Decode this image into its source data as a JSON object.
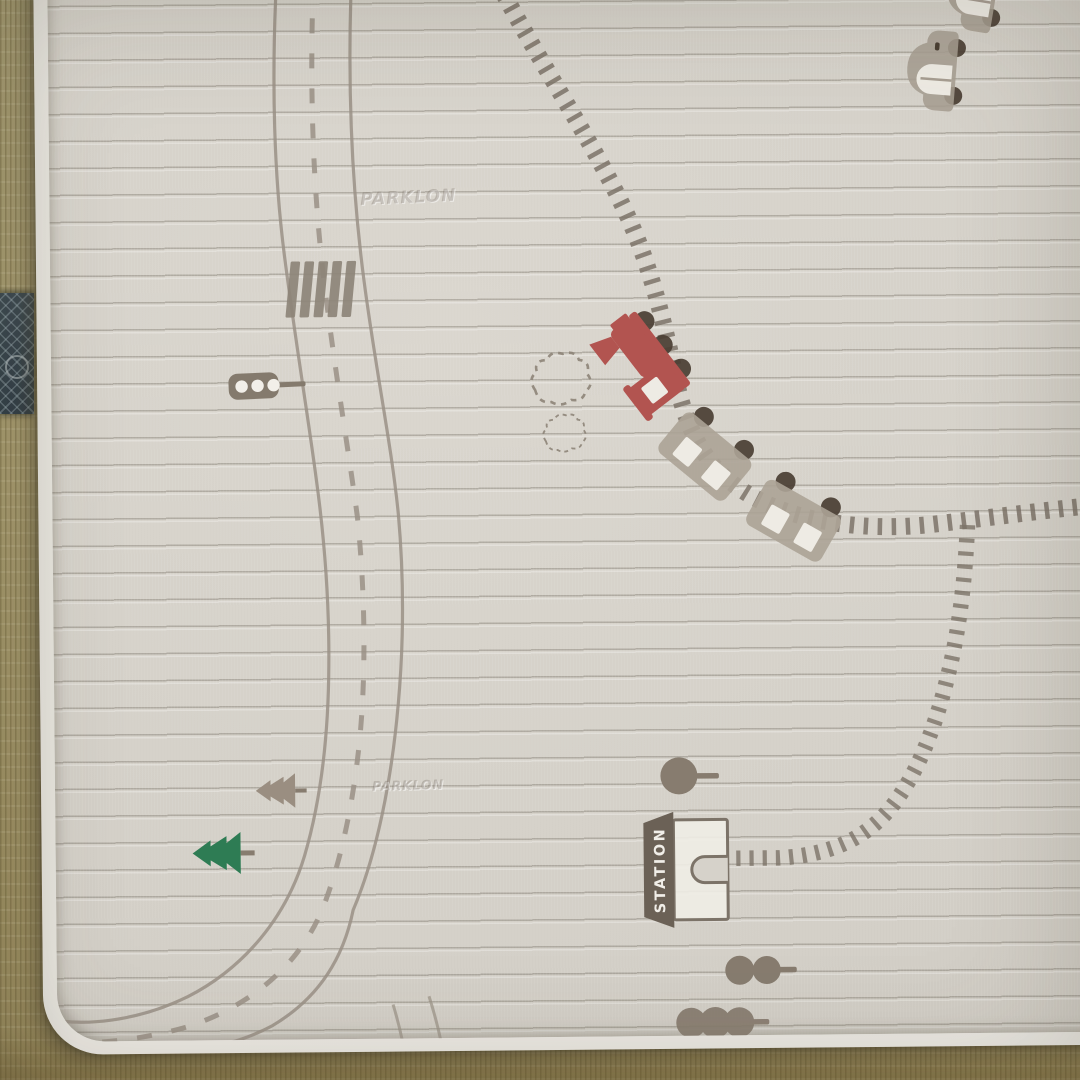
{
  "scene": {
    "type": "photograph",
    "description": "Foldable baby play mat printed with a toy road and railway map, lying on a tatami floor",
    "background": "tatami flooring with a dark diamond-patterned border band on the left"
  },
  "mat": {
    "station_sign": "STATION",
    "brand_watermark": "PARKLON",
    "icons": {
      "steam-train-icon": "red cartoon steam locomotive riding the railway",
      "train-wagon-icon": "gray train wagon with two white windows",
      "car-icon": "gray cartoon car with arched white window",
      "traffic-light-icon": "horizontal traffic light with three white lamps on a pole",
      "crosswalk-icon": "zebra crosswalk stripes across the road",
      "pine-tree-green-icon": "green pine tree lying along the mat",
      "pine-tree-taupe-icon": "taupe pine tree lying along the mat",
      "lollipop-tree-icon": "round tree with short trunk",
      "ball-tree-icon": "bush of round balls with a stick trunk",
      "smoke-puff-icon": "dashed-outline smoke cloud from the locomotive",
      "station-building-icon": "station house with arched door and dark sign roof"
    }
  },
  "colors": {
    "mat_base": "#d6d2ca",
    "mat_rib_line": "#b5b1a8",
    "mat_edge": "#eae8e2",
    "road_marking": "#9a9186",
    "railway_tie": "#7c7368",
    "crosswalk": "#8d8478",
    "train_red": "#b25450",
    "wheel_dark": "#4a3e33",
    "wagon_gray": "#aca396",
    "window_white": "#eeebe4",
    "tree_green": "#2e7c54",
    "tree_taupe": "#9a8e81",
    "bush_taupe": "#877c6f",
    "station_roof": "#6b6156",
    "sign_text": "#f1eee8",
    "tatami": "#a89c70",
    "tatami_border": "#37444a"
  }
}
